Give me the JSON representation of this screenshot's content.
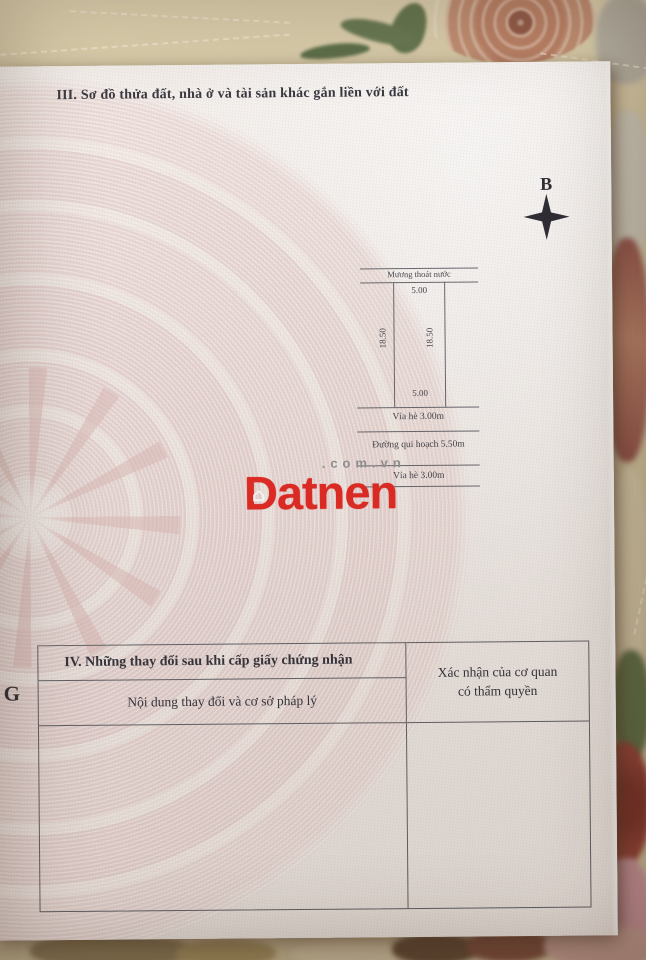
{
  "document": {
    "section_iii": {
      "heading": "III. Sơ đồ thửa đất, nhà ở và tài sản khác gắn liền với đất"
    },
    "compass": {
      "north_label": "B"
    },
    "plot_diagram": {
      "canal_label": "Mương thoát nước",
      "top_width": "5.00",
      "bottom_width": "5.00",
      "left_length": "18.50",
      "right_length": "18.50",
      "sidewalk_front": "Vỉa hè 3.00m",
      "planned_road": "Đường qui hoạch 5.50m",
      "sidewalk_far": "Vỉa hè 3.00m"
    },
    "margin_letter": "G",
    "section_iv": {
      "heading": "IV. Những thay đổi sau khi cấp giấy chứng nhận",
      "col1": "Nội dung thay đổi và cơ sở pháp lý",
      "col2_line1": "Xác nhận của cơ quan",
      "col2_line2": "có thẩm quyền"
    }
  },
  "watermark": {
    "brand": "Datnen",
    "suffix": ".com.vn",
    "brand_color": "#e3221c"
  }
}
